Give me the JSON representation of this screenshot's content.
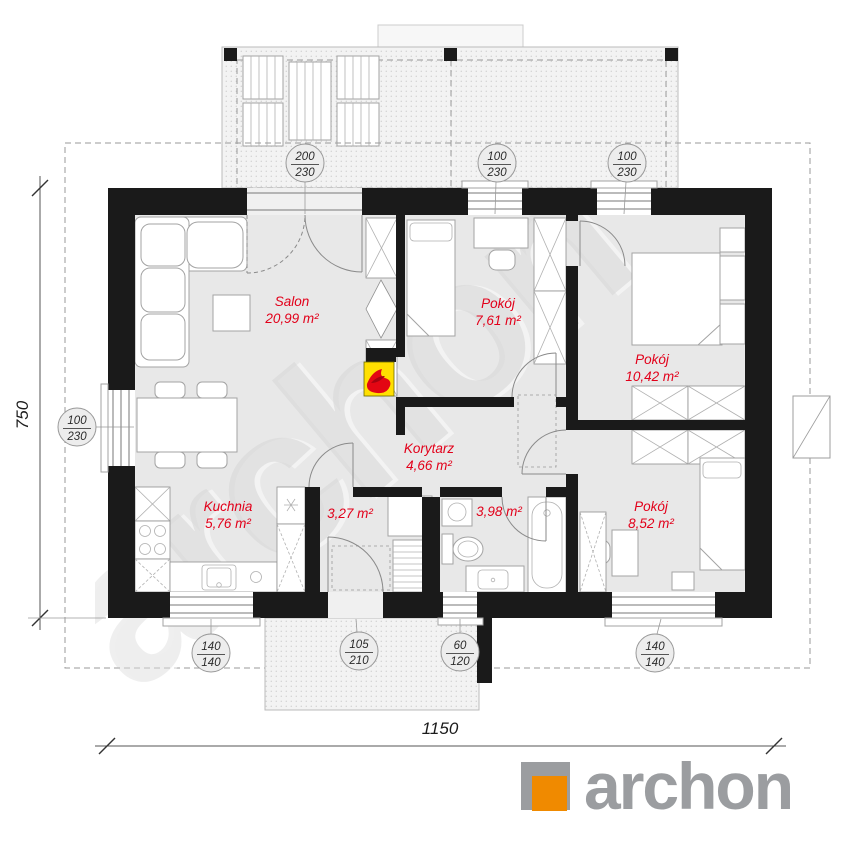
{
  "plan": {
    "watermark": "archon",
    "rooms": [
      {
        "name": "Salon",
        "area": "20,99 m²"
      },
      {
        "name": "Pokój",
        "area": "7,61 m²"
      },
      {
        "name": "Pokój",
        "area": "10,42 m²"
      },
      {
        "name": "Kuchnia",
        "area": "5,76 m²"
      },
      {
        "name": "Korytarz",
        "area": "4,66 m²"
      },
      {
        "name": "",
        "area": "3,27 m²"
      },
      {
        "name": "",
        "area": "3,98 m²"
      },
      {
        "name": "Pokój",
        "area": "8,52 m²"
      }
    ],
    "windows": [
      {
        "w": "200",
        "h": "230"
      },
      {
        "w": "100",
        "h": "230"
      },
      {
        "w": "100",
        "h": "230"
      },
      {
        "w": "100",
        "h": "230"
      },
      {
        "w": "140",
        "h": "140"
      },
      {
        "w": "105",
        "h": "210"
      },
      {
        "w": "60",
        "h": "120"
      },
      {
        "w": "140",
        "h": "140"
      }
    ],
    "overall": {
      "width": "1150",
      "depth": "750"
    }
  },
  "logo": {
    "text": "archon"
  },
  "colors": {
    "room_label_red": "#e2001a",
    "wall_black": "#1a1a1a",
    "fireplace_yellow": "#ffdf00",
    "flame_red": "#e30613",
    "logo_gray": "#9b9da0",
    "logo_orange": "#f08a00"
  }
}
